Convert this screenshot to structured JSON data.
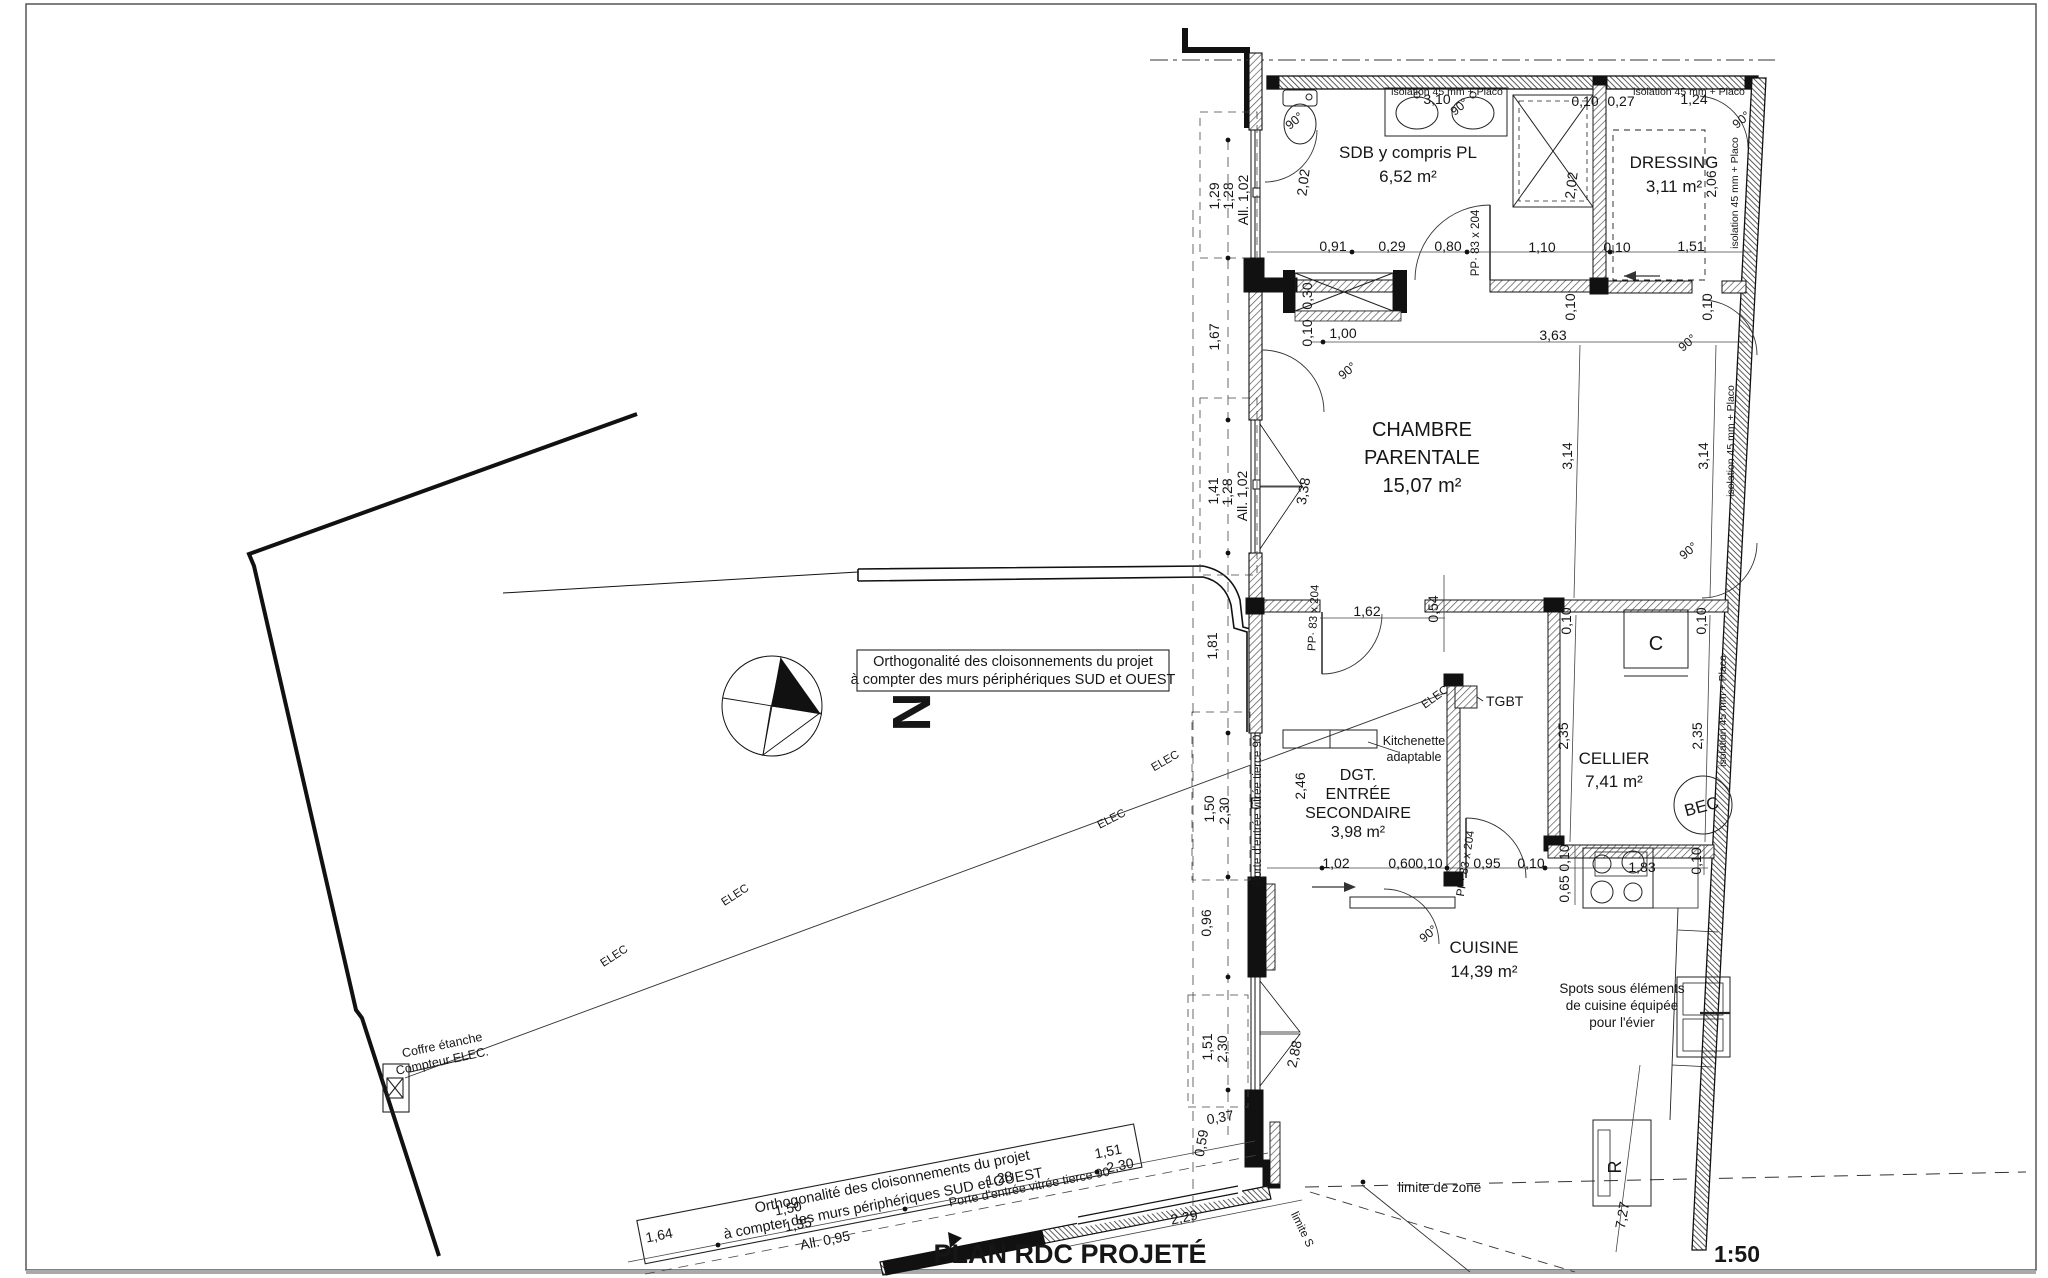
{
  "drawing": {
    "title": "PLAN RDC PROJETÉ",
    "scale": "1:50",
    "north": "N",
    "type": "floor-plan"
  },
  "rooms": [
    {
      "name": "SDB y compris PL",
      "area": "6,52 m²",
      "lines": [
        "SDB y compris PL",
        "6,52 m²"
      ],
      "cx": 1408,
      "cy": 158,
      "dy": 24,
      "s": 17
    },
    {
      "name": "DRESSING",
      "area": "3,11 m²",
      "lines": [
        "DRESSING",
        "3,11 m²"
      ],
      "cx": 1674,
      "cy": 168,
      "dy": 24,
      "s": 17
    },
    {
      "name": "CHAMBRE PARENTALE",
      "area": "15,07 m²",
      "lines": [
        "CHAMBRE",
        "PARENTALE",
        "15,07 m²"
      ],
      "cx": 1422,
      "cy": 436,
      "dy": 28,
      "s": 20
    },
    {
      "name": "DGT. ENTRÉE SECONDAIRE",
      "area": "3,98 m²",
      "lines": [
        "DGT.",
        "ENTRÉE",
        "SECONDAIRE",
        "3,98 m²"
      ],
      "cx": 1358,
      "cy": 780,
      "dy": 19,
      "s": 16
    },
    {
      "name": "CELLIER",
      "area": "7,41 m²",
      "lines": [
        "CELLIER",
        "7,41 m²"
      ],
      "cx": 1614,
      "cy": 764,
      "dy": 23,
      "s": 17
    },
    {
      "name": "CUISINE",
      "area": "14,39 m²",
      "lines": [
        "CUISINE",
        "14,39 m²"
      ],
      "cx": 1484,
      "cy": 953,
      "dy": 24,
      "s": 17
    }
  ],
  "labels": [
    {
      "t": "PLAN RDC PROJETÉ",
      "x": 1070,
      "y": 1263,
      "s": 27,
      "b": 1,
      "n": "plan-title"
    },
    {
      "t": "1:50",
      "x": 1737,
      "y": 1262,
      "s": 23,
      "b": 1,
      "n": "scale-label"
    },
    {
      "t": "N",
      "x": 893,
      "y": 712,
      "s": 54,
      "b": 1,
      "r": 90,
      "n": "north-letter"
    },
    {
      "t": "Orthogonalité des cloisonnements du projet",
      "x": 1013,
      "y": 666,
      "s": 14.5,
      "n": "note-orthogonality-1"
    },
    {
      "t": "à compter des murs périphériques SUD et OUEST",
      "x": 1013,
      "y": 684,
      "s": 14.5,
      "n": "note-orthogonality-1"
    },
    {
      "t": "Orthogonalité des cloisonnements du projet",
      "x": 893,
      "y": 1186,
      "s": 14.5,
      "r": -11,
      "n": "note-orthogonality-2"
    },
    {
      "t": "à compter des murs périphériques SUD et OUEST",
      "x": 884,
      "y": 1208,
      "s": 14.5,
      "r": -11,
      "n": "note-orthogonality-2"
    },
    {
      "t": "isolation 45 mm + Placo",
      "x": 1447,
      "y": 95,
      "s": 10.5,
      "n": "insulation-note"
    },
    {
      "t": "isolation 45 mm + Placo",
      "x": 1689,
      "y": 95,
      "s": 10.5,
      "n": "insulation-note"
    },
    {
      "t": "isolation 45 mm + Placo",
      "x": 1738,
      "y": 193,
      "s": 10.5,
      "r": -90,
      "n": "insulation-note"
    },
    {
      "t": "isolation 45 mm + Placo",
      "x": 1734,
      "y": 441,
      "s": 10.5,
      "r": -90,
      "n": "insulation-note"
    },
    {
      "t": "isolation 45 mm + Placo",
      "x": 1726,
      "y": 711,
      "s": 10.5,
      "r": -90,
      "n": "insulation-note"
    },
    {
      "t": "TGBT",
      "x": 1486,
      "y": 706,
      "s": 14,
      "a": "start",
      "n": "tgbt-label"
    },
    {
      "t": "Kitchenette",
      "x": 1414,
      "y": 745,
      "s": 12.5,
      "n": "kitchenette-note"
    },
    {
      "t": "adaptable",
      "x": 1414,
      "y": 761,
      "s": 12.5,
      "n": "kitchenette-note"
    },
    {
      "t": "Spots sous éléments",
      "x": 1622,
      "y": 993,
      "s": 13.5,
      "n": "spots-note"
    },
    {
      "t": "de cuisine équipée",
      "x": 1622,
      "y": 1010,
      "s": 13.5,
      "n": "spots-note"
    },
    {
      "t": "pour l'évier",
      "x": 1622,
      "y": 1027,
      "s": 13.5,
      "n": "spots-note"
    },
    {
      "t": "Porte d'entrée vitrée tierce 90",
      "x": 1261,
      "y": 810,
      "s": 11.5,
      "r": -90,
      "n": "entry-door-note"
    },
    {
      "t": "Porte d'entrée vitrée tierce 90",
      "x": 1030,
      "y": 1191,
      "s": 12.5,
      "r": -11,
      "n": "entry-door-note"
    },
    {
      "t": "PP· 83 x 204",
      "x": 1479,
      "y": 243,
      "s": 11.5,
      "r": -90,
      "n": "door-size-note"
    },
    {
      "t": "PP· 83 x 204",
      "x": 1317,
      "y": 618,
      "s": 11.5,
      "r": -87,
      "n": "door-size-note"
    },
    {
      "t": "PP· 83 x 204",
      "x": 1469,
      "y": 864,
      "s": 11.5,
      "r": -81,
      "n": "door-size-note"
    },
    {
      "t": "90°",
      "x": 1297,
      "y": 124,
      "s": 12.5,
      "r": -40,
      "n": "angle-label"
    },
    {
      "t": "90°",
      "x": 1462,
      "y": 110,
      "s": 12.5,
      "r": -40,
      "n": "angle-label"
    },
    {
      "t": "90°",
      "x": 1744,
      "y": 123,
      "s": 12.5,
      "r": -40,
      "n": "angle-label"
    },
    {
      "t": "90°",
      "x": 1350,
      "y": 374,
      "s": 12.5,
      "r": -40,
      "n": "angle-label"
    },
    {
      "t": "90°",
      "x": 1690,
      "y": 346,
      "s": 12.5,
      "r": -40,
      "n": "angle-label"
    },
    {
      "t": "90°",
      "x": 1691,
      "y": 554,
      "s": 12.5,
      "r": -40,
      "n": "angle-label"
    },
    {
      "t": "90°",
      "x": 1431,
      "y": 937,
      "s": 12.5,
      "r": -40,
      "n": "angle-label"
    },
    {
      "t": "ELEC",
      "x": 616,
      "y": 959,
      "s": 11.5,
      "r": -33,
      "n": "elec-label"
    },
    {
      "t": "ELEC",
      "x": 737,
      "y": 898,
      "s": 11.5,
      "r": -33,
      "n": "elec-label"
    },
    {
      "t": "ELEC",
      "x": 1113,
      "y": 822,
      "s": 11.5,
      "r": -27,
      "n": "elec-label"
    },
    {
      "t": "ELEC",
      "x": 1167,
      "y": 764,
      "s": 11.5,
      "r": -30,
      "n": "elec-label"
    },
    {
      "t": "ELEC",
      "x": 1437,
      "y": 700,
      "s": 11.5,
      "r": -36,
      "n": "elec-label"
    },
    {
      "t": "limite de zone",
      "x": 1398,
      "y": 1192,
      "s": 13.5,
      "a": "start",
      "n": "zone-limit-label"
    },
    {
      "t": "limite S",
      "x": 1299,
      "y": 1231,
      "s": 11.5,
      "r": 64,
      "n": "zone-limit-label"
    },
    {
      "t": "Coffre étanche",
      "x": 443,
      "y": 1049,
      "s": 12.5,
      "r": -12,
      "n": "meter-box-note"
    },
    {
      "t": "Compteur ELEC.",
      "x": 443,
      "y": 1065,
      "s": 12.5,
      "r": -12,
      "n": "meter-box-note"
    },
    {
      "t": "C",
      "x": 1656,
      "y": 650,
      "s": 20,
      "n": "boiler-label"
    },
    {
      "t": "BEC",
      "x": 1703,
      "y": 812,
      "s": 17,
      "r": -15,
      "n": "bec-label"
    },
    {
      "t": "R",
      "x": 1621,
      "y": 1167,
      "s": 18,
      "r": -90,
      "n": "fridge-label"
    }
  ],
  "dimensions": [
    {
      "t": "3,10",
      "x": 1437,
      "y": 104
    },
    {
      "t": "0,10",
      "x": 1585,
      "y": 106
    },
    {
      "t": "0,27",
      "x": 1621,
      "y": 106
    },
    {
      "t": "1,24",
      "x": 1694,
      "y": 104
    },
    {
      "t": "2,02",
      "x": 1576,
      "y": 186,
      "r": -83
    },
    {
      "t": "2,06",
      "x": 1716,
      "y": 184,
      "r": -90
    },
    {
      "t": "0,91",
      "x": 1333,
      "y": 251
    },
    {
      "t": "0,29",
      "x": 1392,
      "y": 251
    },
    {
      "t": "0,80",
      "x": 1448,
      "y": 251
    },
    {
      "t": "1,10",
      "x": 1542,
      "y": 252
    },
    {
      "t": "0,10",
      "x": 1617,
      "y": 252
    },
    {
      "t": "1,51",
      "x": 1691,
      "y": 251
    },
    {
      "t": "2,02",
      "x": 1308,
      "y": 183,
      "r": -83
    },
    {
      "t": "1,29",
      "x": 1219,
      "y": 196,
      "r": -90
    },
    {
      "t": "1,28",
      "x": 1233,
      "y": 196,
      "r": -90
    },
    {
      "t": "All. 1,02",
      "x": 1248,
      "y": 200,
      "r": -90
    },
    {
      "t": "0,30",
      "x": 1312,
      "y": 296,
      "r": -90
    },
    {
      "t": "0,10",
      "x": 1312,
      "y": 333,
      "r": -90
    },
    {
      "t": "1,00",
      "x": 1343,
      "y": 338
    },
    {
      "t": "3,63",
      "x": 1553,
      "y": 340
    },
    {
      "t": "0,10",
      "x": 1575,
      "y": 307,
      "r": -90
    },
    {
      "t": "0,10",
      "x": 1712,
      "y": 307,
      "r": -90
    },
    {
      "t": "3,14",
      "x": 1572,
      "y": 456,
      "r": -90
    },
    {
      "t": "3,14",
      "x": 1708,
      "y": 456,
      "r": -90
    },
    {
      "t": "1,67",
      "x": 1219,
      "y": 337,
      "r": -90
    },
    {
      "t": "1,41",
      "x": 1218,
      "y": 491,
      "r": -90
    },
    {
      "t": "1,28",
      "x": 1232,
      "y": 492,
      "r": -90
    },
    {
      "t": "All. 1,02",
      "x": 1247,
      "y": 496,
      "r": -90
    },
    {
      "t": "3,38",
      "x": 1308,
      "y": 492,
      "r": -80
    },
    {
      "t": "1,81",
      "x": 1217,
      "y": 646,
      "r": -90
    },
    {
      "t": "1,62",
      "x": 1367,
      "y": 616
    },
    {
      "t": "0,54",
      "x": 1438,
      "y": 609,
      "r": -90
    },
    {
      "t": "0,10",
      "x": 1571,
      "y": 621,
      "r": -90
    },
    {
      "t": "0,10",
      "x": 1706,
      "y": 621,
      "r": -90
    },
    {
      "t": "2,35",
      "x": 1568,
      "y": 736,
      "r": -90
    },
    {
      "t": "2,35",
      "x": 1702,
      "y": 736,
      "r": -90
    },
    {
      "t": "2,46",
      "x": 1305,
      "y": 786,
      "r": -90
    },
    {
      "t": "1,50",
      "x": 1214,
      "y": 809,
      "r": -90
    },
    {
      "t": "2,30",
      "x": 1229,
      "y": 811,
      "r": -90
    },
    {
      "t": "1,02",
      "x": 1336,
      "y": 868
    },
    {
      "t": "0,60",
      "x": 1402,
      "y": 868
    },
    {
      "t": "0,10",
      "x": 1429,
      "y": 868
    },
    {
      "t": "0,95",
      "x": 1487,
      "y": 868
    },
    {
      "t": "0,10",
      "x": 1531,
      "y": 868
    },
    {
      "t": "0,10",
      "x": 1569,
      "y": 858,
      "r": -90
    },
    {
      "t": "0,65",
      "x": 1569,
      "y": 889,
      "r": -90
    },
    {
      "t": "1,83",
      "x": 1642,
      "y": 872
    },
    {
      "t": "0,10",
      "x": 1701,
      "y": 861,
      "r": -90
    },
    {
      "t": "0,96",
      "x": 1211,
      "y": 923,
      "r": -90
    },
    {
      "t": "1,51",
      "x": 1212,
      "y": 1047,
      "r": -90
    },
    {
      "t": "2,30",
      "x": 1227,
      "y": 1049,
      "r": -90
    },
    {
      "t": "2,88",
      "x": 1299,
      "y": 1055,
      "r": -78
    },
    {
      "t": "0,37",
      "x": 1221,
      "y": 1122,
      "r": -10
    },
    {
      "t": "0,59",
      "x": 1206,
      "y": 1144,
      "r": -80
    },
    {
      "t": "1,64",
      "x": 660,
      "y": 1240,
      "r": -11
    },
    {
      "t": "1,50",
      "x": 789,
      "y": 1213,
      "r": -11
    },
    {
      "t": "1,35",
      "x": 799,
      "y": 1229,
      "r": -11
    },
    {
      "t": "All. 0,95",
      "x": 826,
      "y": 1245,
      "r": -11
    },
    {
      "t": "1,28",
      "x": 1000,
      "y": 1183,
      "r": -11
    },
    {
      "t": "1,51",
      "x": 1109,
      "y": 1156,
      "r": -11
    },
    {
      "t": "2,30",
      "x": 1121,
      "y": 1170,
      "r": -11
    },
    {
      "t": "2,29",
      "x": 1185,
      "y": 1222,
      "r": -11
    },
    {
      "t": "7,27",
      "x": 1627,
      "y": 1216,
      "r": -80
    }
  ]
}
